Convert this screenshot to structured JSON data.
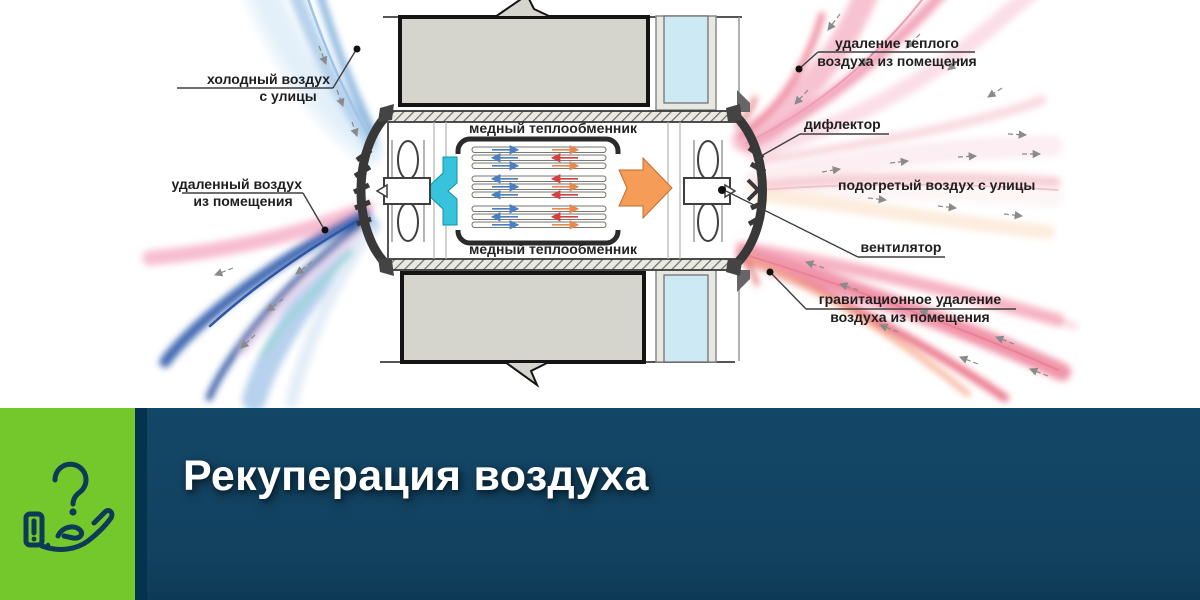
{
  "diagram": {
    "labels": {
      "cold_air": {
        "line1": "холодный воздух",
        "line2": "с улицы"
      },
      "removed_air": {
        "line1": "удаленный воздух",
        "line2": "из помещения"
      },
      "warm_removal": {
        "line1": "удаление теплого",
        "line2": "воздуха из помещения"
      },
      "deflector": "дифлектор",
      "heated_air": "подогретый воздух с улицы",
      "fan": "вентилятор",
      "gravity_removal": {
        "line1": "гравитационное удаление",
        "line2": "воздуха из помещения"
      },
      "exchanger_top": "медный теплообменник",
      "exchanger_bottom": "медный теплообменник"
    },
    "colors": {
      "wall_gray": "#d5d5cd",
      "insulation_cyan": "#cde9f3",
      "extract_arrow_cyan": "#38c3dd",
      "supply_arrow_orange": "#f49c58",
      "cold_stream_blue": "#7fb0dc",
      "exhaust_stream_blue": "#2a4f9e",
      "warm_stream_pink": "#f2a6bd",
      "heated_stream_pink": "#f6cdd6"
    }
  },
  "banner": {
    "title": "Рекуперация воздуха",
    "icon": "question-hand-icon",
    "colors": {
      "green": "#74c82c",
      "navy": "#12415f",
      "divider": "#04334e",
      "title_text": "#ffffff"
    }
  }
}
